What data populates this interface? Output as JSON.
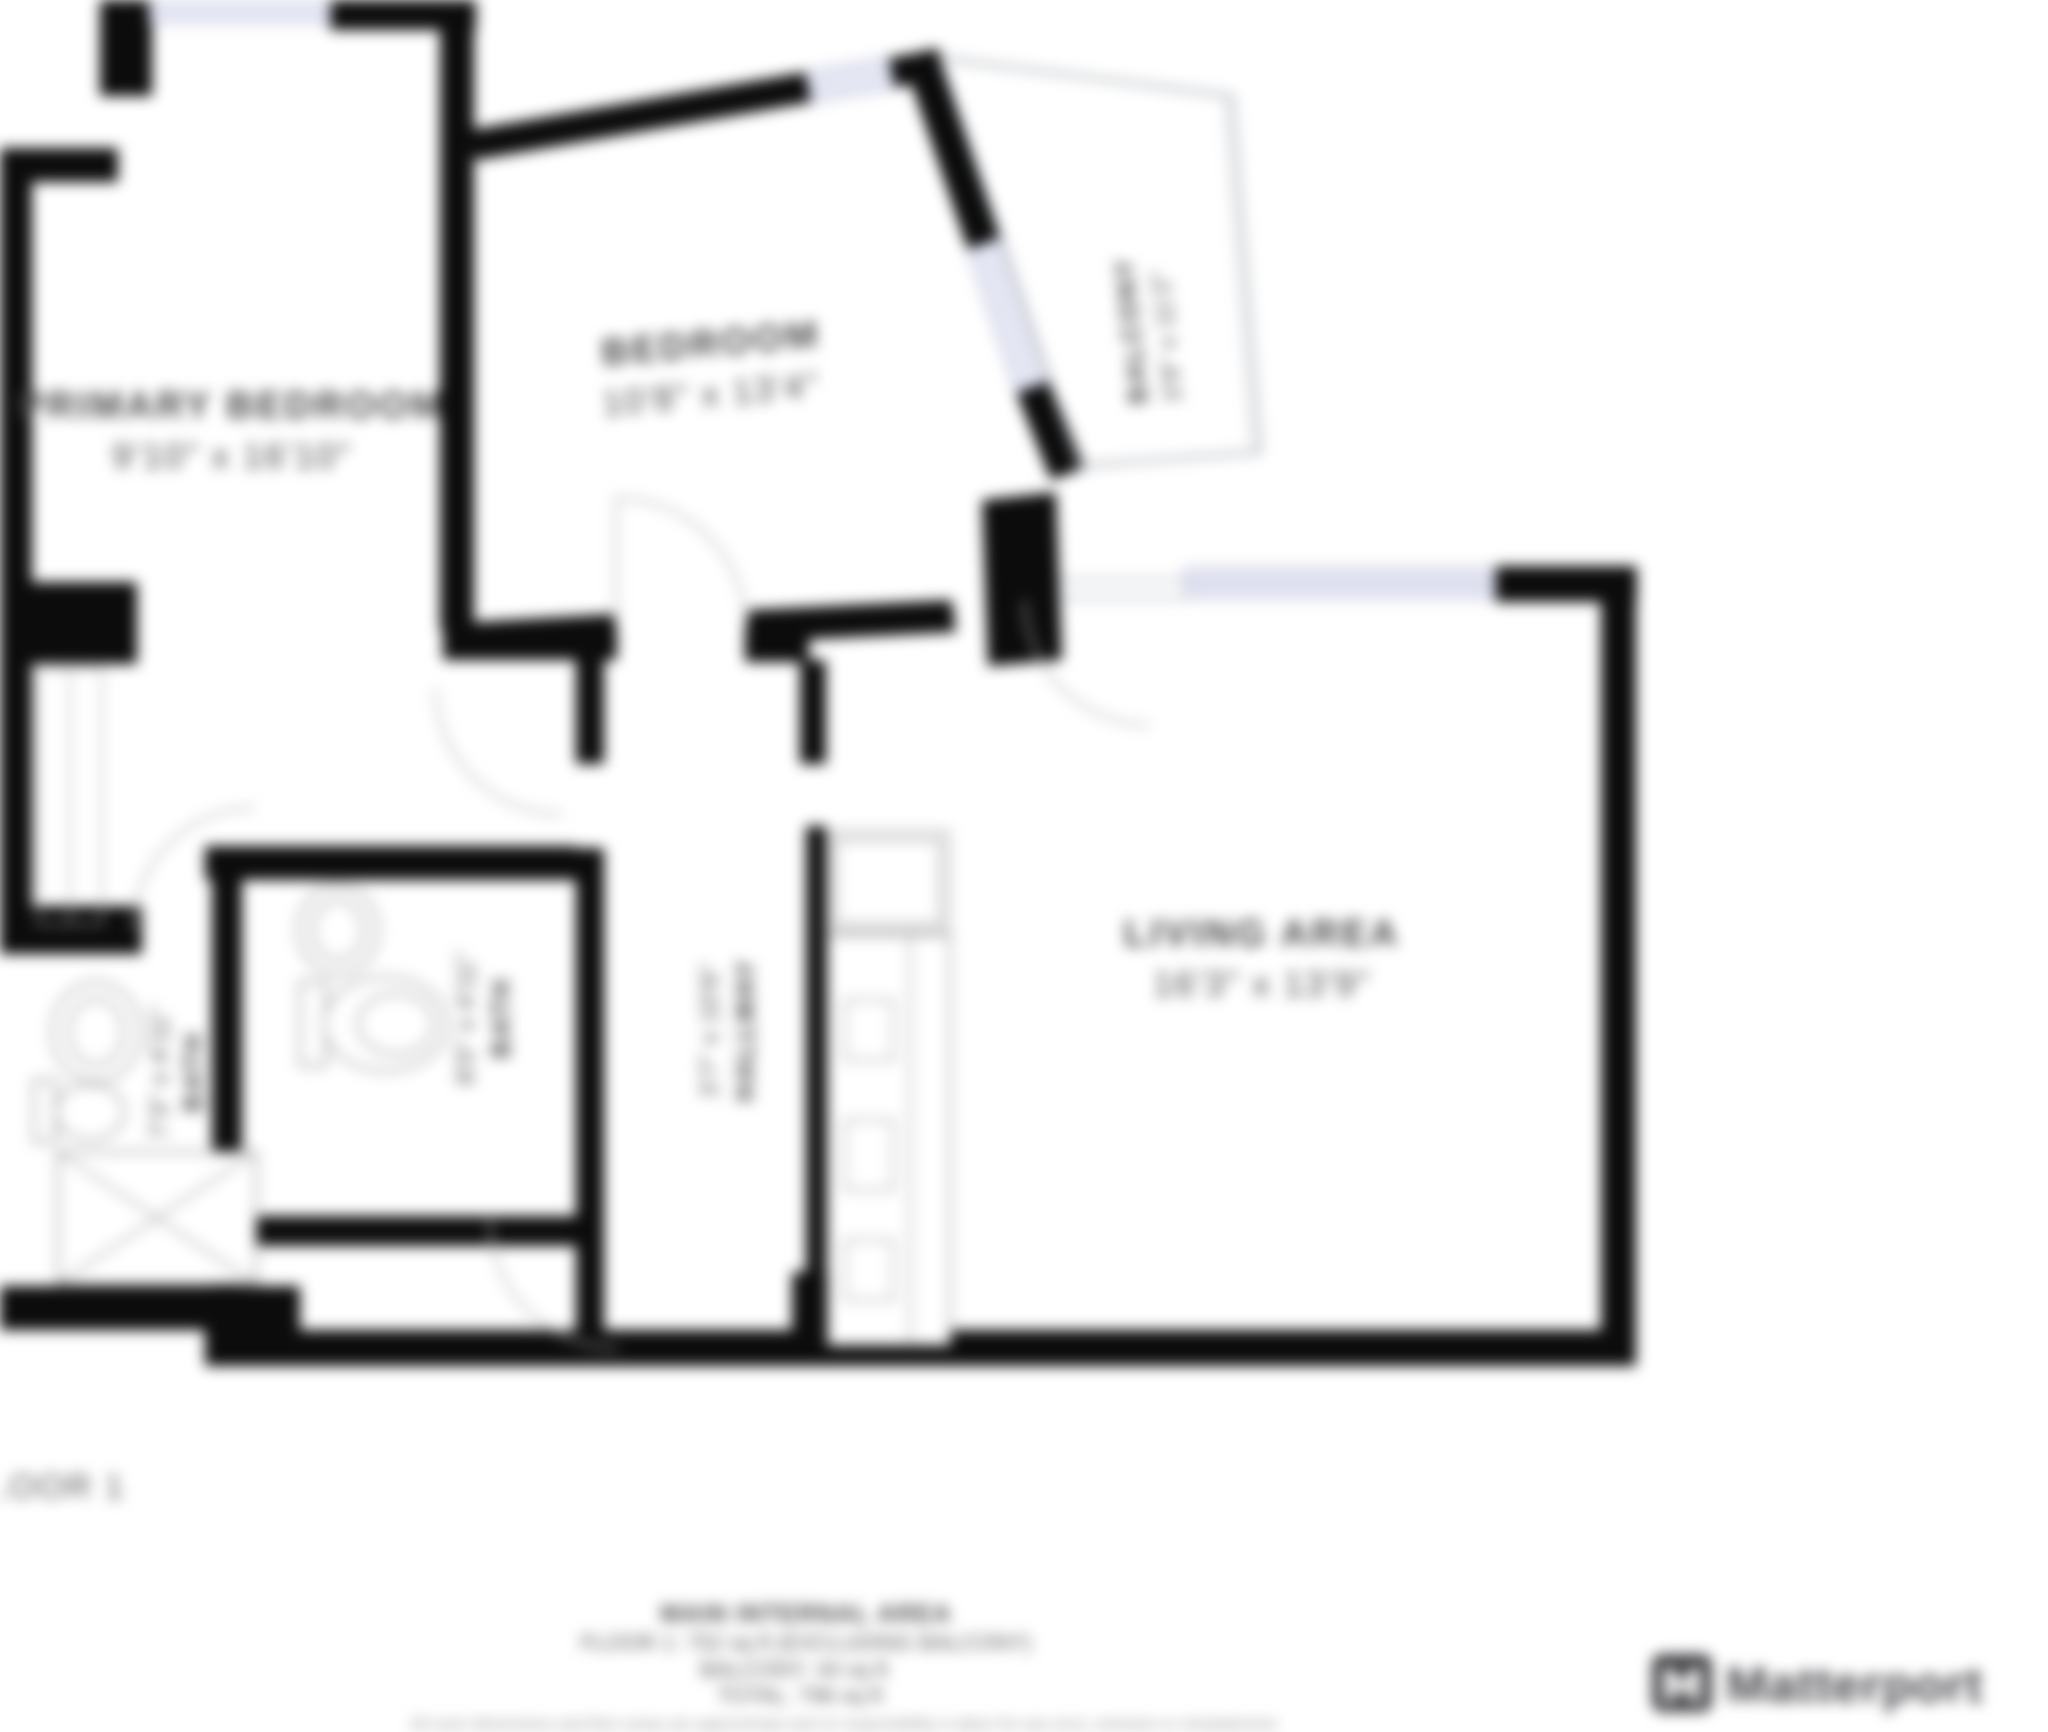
{
  "plan": {
    "rooms": {
      "primary_bedroom": {
        "name": "PRIMARY BEDROOM",
        "dims": "9'10\" x 16'10\""
      },
      "bedroom": {
        "name": "BEDROOM",
        "dims": "10'8\" x 13'4\""
      },
      "living_area": {
        "name": "LIVING AREA",
        "dims": "16'3\" x 13'9\""
      },
      "balcony": {
        "name": "BALCONY",
        "dims": "3'9\" x 11'2\""
      },
      "bath_1": {
        "name": "BATH",
        "dims": "7'3\" x 4'11\""
      },
      "bath_2": {
        "name": "BATH",
        "dims": "8'0\" x 4'11\""
      },
      "hallway": {
        "name": "HALLWAY",
        "dims": "3'7\" x 10'6\""
      }
    },
    "floor_label": "FLOOR 1"
  },
  "footer": {
    "title": "MAIN INTERNAL AREA",
    "floor_line": "FLOOR 1: 752 sq ft (EXCLUDING BALCONY)",
    "balcony_line": "BALCONY: 44 sq ft",
    "total_line": "TOTAL: 796 sq ft",
    "disclaimer": "All room dimensions and floor areas are approximate and no responsibility is taken for any error, omission or misstatement."
  },
  "branding": {
    "logo_text": "Matterport"
  },
  "colors": {
    "wall": "#0c0c0c",
    "window_fill": "#e4e6f3",
    "window_stroke": "#b6bad4",
    "fixture_stroke": "#979797",
    "door_arc": "#b5b5b5",
    "label_text": "#474747",
    "brand": "#45454a"
  }
}
